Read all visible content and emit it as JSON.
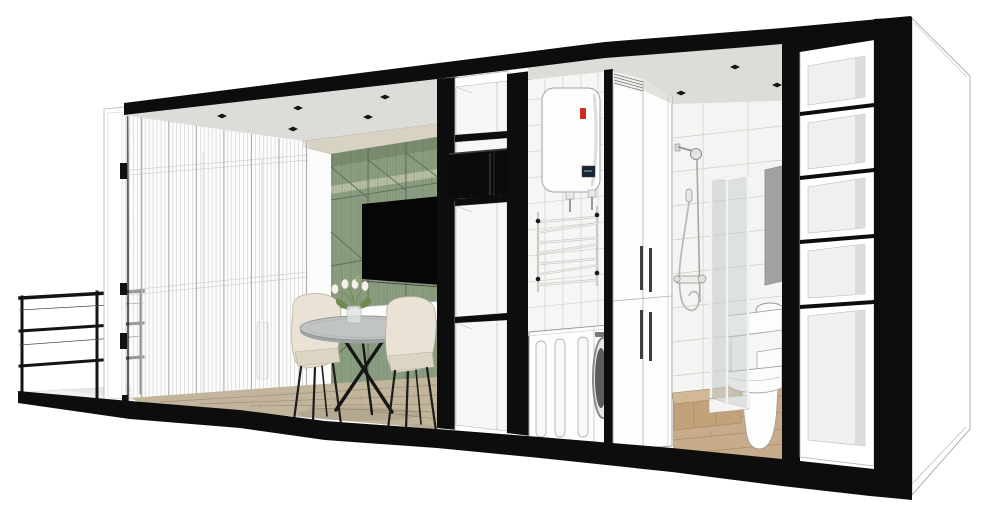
{
  "meta": {
    "description": "Cutaway section perspective render of a compact container apartment: balcony with guardrail, glazed living-dining room with sheer curtains, green geometric TV wall, open shelving with microwave, utility niche with water heater, towel ladder and washing machine, tall wardrobe, bathroom with shower, basin and toilet, and an open storage column on the right gable",
    "render_style": "SketchUp-style 3D section render, black poche cut walls, no visible text"
  },
  "palette": {
    "frame": "#0d0d0d",
    "wall": "#ffffff",
    "outline": "#a6a6a3",
    "ceiling": "#dcdcd9",
    "soffit": "#d8d2c3",
    "backwall": "#fbfbfa",
    "curtain": "#c6c6c6",
    "curtain_dark": "#a4a4a2",
    "green": "#8d9f82",
    "green_dark": "#7b8d70",
    "green_line": "#5f6d57",
    "green_light": "#b7bfa7",
    "green_texture": "#46543f",
    "tv": "#060606",
    "wood": "#c3b59c",
    "wood_line": "#97896f",
    "bath_wood": "#c7ab8a",
    "bath_wood_line": "#a1875f",
    "platform_top": "#d3b896",
    "platform_front": "#c2a17b",
    "tile": "#f4f4f2",
    "tile_utility": "#f6f6f4",
    "grout": "#d4d4d1",
    "fixture": "#fdfdfc",
    "fixture_line": "#a0a09c",
    "glass": "#c3cbcb",
    "glass_frame": "#f2f2f0",
    "mirror": "#a2a2a0",
    "chrome": "#9a9a98",
    "cream": "#eae3d5",
    "cream_dark": "#ddd5c3",
    "table_top": "#c0c4c3",
    "table_rim": "#9fa3a2",
    "metal": "#161616",
    "heater_red": "#cc2a22",
    "heater_display": "#1b2430",
    "leaf_green": "#6f8a4f",
    "stem_green": "#7a9156",
    "flower_white": "#f4f1e8",
    "shelf_back": "#f0f0ef",
    "shelf_side": "#dcdcda",
    "handle_dark": "#3c3c3c"
  },
  "scene": {
    "balcony": {
      "items": [
        "metal-guardrail",
        "glass-sliding-door",
        "balcony-slab"
      ]
    },
    "living_dining": {
      "items": [
        "sheer-curtain-wall",
        "recessed-ceiling-spots",
        "green-geometric-accent-wall",
        "wall-mounted-tv",
        "floating-sideboard",
        "round-dining-table",
        "dining-chair",
        "dining-chair",
        "flower-vase",
        "wood-plank-floor",
        "radiator"
      ],
      "chair_count": 2,
      "ceiling_spot_count": 5
    },
    "mid_shelving": {
      "items": [
        "open-shelf-column",
        "microwave"
      ],
      "shelf_cells": 4
    },
    "utility": {
      "items": [
        "electric-water-heater",
        "towel-ladder-rack",
        "washing-machine",
        "white-wall-tiles"
      ]
    },
    "wardrobe": {
      "items": [
        "tall-two-by-two-door-cabinet",
        "vertical-bar-handles"
      ],
      "door_count": 4
    },
    "bathroom": {
      "items": [
        "white-square-tiles",
        "recessed-ceiling-spots",
        "shower-rail-set",
        "hand-shower",
        "shower-mixer",
        "folding-glass-screen",
        "mirror-panel",
        "countertop-basin",
        "toilet",
        "wood-step-platform",
        "wood-plank-floor"
      ],
      "ceiling_spot_count": 3
    },
    "right_storage": {
      "items": [
        "open-shelf-column-gable"
      ],
      "shelf_cells": 5
    },
    "shell": {
      "items": [
        "black-section-roof-band",
        "black-section-base-band",
        "black-section-columns",
        "white-exterior-gable-wall"
      ]
    }
  }
}
